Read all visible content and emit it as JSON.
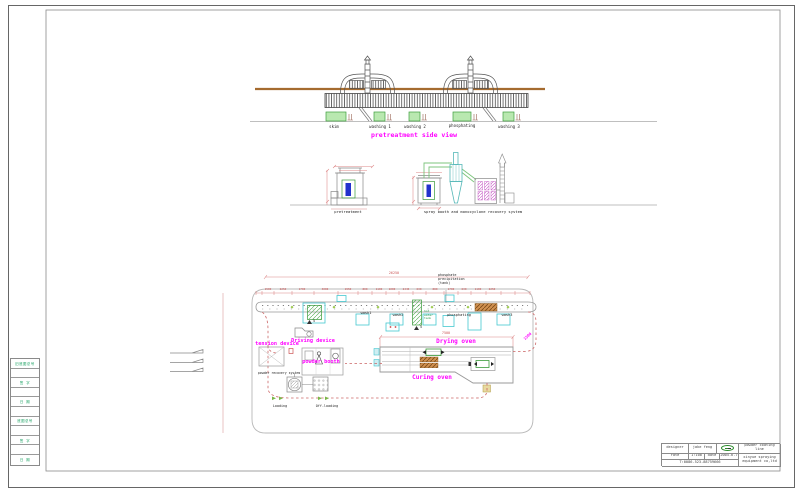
{
  "sheet": {
    "left_strip": {
      "cells": [
        "旧底图总号",
        "",
        "签  字",
        "",
        "日  期",
        "",
        "底图总号",
        "",
        "签  字",
        "",
        "日  期"
      ]
    },
    "title_block": {
      "designer_label": "designer",
      "designer_value": "jake feng",
      "rate_label": "rate",
      "rate_value": "1:100",
      "date_label": "date",
      "date_value": "2005.6.7",
      "phone": "T:0086-523-88759666",
      "product": "powder coating line",
      "company": "xinyue spraying equipment co,ltd"
    }
  },
  "side_view": {
    "title": "pretreatment side view",
    "tank_labels": [
      "skim",
      "washing 1",
      "washing 2",
      "phosphating",
      "washing 3"
    ]
  },
  "elevation_view": {
    "pretreatment_label": "pretreatment",
    "spray_system_label": "spray booth and monocyclone recovery system"
  },
  "plan_view": {
    "tension_device": "tension device",
    "driving_device": "Driving device",
    "powder_booth": "powder booth",
    "powder_recovery": "powder recovery system",
    "loading": "Loading",
    "offloading": "Off-loading",
    "drying_oven": "Drying oven",
    "curing_oven": "Curing oven",
    "phosphate_line1": "phosphate",
    "phosphate_line2": "precipitation",
    "phosphate_line3": "(tank)",
    "hot_water_line1": "hot",
    "hot_water_line2": "water",
    "hot_water_line3": "tank",
    "wash1": "wash1",
    "wash2": "wash2",
    "wash3": "wash3",
    "phosphating": "phosphating",
    "marker_5a": "5",
    "marker_5b": "5",
    "dims": {
      "overall": "26250",
      "oven": "7500",
      "radius": "1500",
      "segments": [
        "1500",
        "2250",
        "1700",
        "3000",
        "1950",
        "800",
        "1100",
        "1000",
        "2445",
        "630",
        "880",
        "1700",
        "630",
        "1100",
        "2250"
      ]
    }
  },
  "colors": {
    "accent_magenta": "#ff00ff",
    "dim_red": "#cc5555",
    "tank_green": "#b9e8b0",
    "duct_green": "#7cc47c",
    "cyan": "#45c8d0",
    "brown": "#c8833c"
  }
}
